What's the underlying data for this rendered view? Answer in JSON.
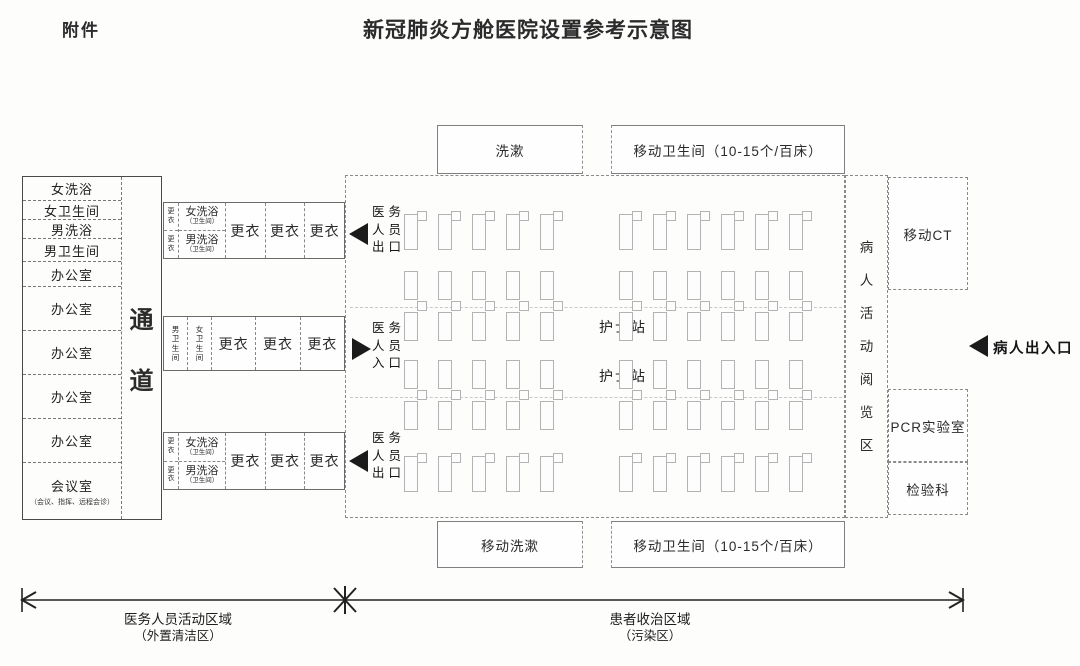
{
  "header": {
    "attachment": "附件",
    "title": "新冠肺炎方舱医院设置参考示意图"
  },
  "left_block": {
    "rooms": [
      "女洗浴",
      "女卫生间",
      "男洗浴",
      "男卫生间",
      "办公室",
      "办公室",
      "办公室",
      "办公室",
      "办公室"
    ],
    "meeting_room": {
      "label": "会议室",
      "note": "（会议、指挥、远程会诊）"
    },
    "corridor_chars": [
      "通",
      "道"
    ]
  },
  "top_band": {
    "changing_small": [
      "更衣",
      "更衣"
    ],
    "female_shower": "女洗浴",
    "female_shower_note": "（卫生间）",
    "male_shower": "男洗浴",
    "male_shower_note": "（卫生间）",
    "changing_rooms": [
      "更衣",
      "更衣",
      "更衣"
    ]
  },
  "middle_band": {
    "male_wc": "男卫生间",
    "female_wc": "女卫生间",
    "changing_rooms": [
      "更衣",
      "更衣",
      "更衣"
    ]
  },
  "bottom_band": {
    "changing_small": [
      "更衣",
      "更衣"
    ],
    "female_shower": "女洗浴",
    "female_shower_note": "（卫生间）",
    "male_shower": "男洗浴",
    "male_shower_note": "（卫生间）",
    "changing_rooms": [
      "更衣",
      "更衣",
      "更衣"
    ]
  },
  "staff_doors": [
    {
      "lines": [
        "医务",
        "人员",
        "出口"
      ],
      "direction": "left"
    },
    {
      "lines": [
        "医务",
        "人员",
        "入口"
      ],
      "direction": "right"
    },
    {
      "lines": [
        "医务",
        "人员",
        "出口"
      ],
      "direction": "left"
    }
  ],
  "utility_top": {
    "wash": "洗漱",
    "mobile_toilet": "移动卫生间（10-15个/百床）"
  },
  "utility_bottom": {
    "wash": "移动洗漱",
    "mobile_toilet": "移动卫生间（10-15个/百床）"
  },
  "ward": {
    "nurse_stations": [
      "护士站",
      "护士站"
    ],
    "reading_area": "病人活动阅览区",
    "beds": {
      "bands": [
        {
          "type": "single",
          "left": 5,
          "right": 6
        },
        {
          "type": "double",
          "left": 5,
          "right": 6
        },
        {
          "type": "double",
          "left": 5,
          "right": 6
        },
        {
          "type": "single",
          "left": 5,
          "right": 6
        }
      ]
    }
  },
  "right_rooms": [
    "移动CT",
    "PCR实验室",
    "检验科"
  ],
  "patient_door": {
    "label": "病人出入口"
  },
  "zones": [
    {
      "label": "医务人员活动区域",
      "note": "（外置清洁区）"
    },
    {
      "label": "患者收治区域",
      "note": "（污染区）"
    }
  ],
  "colors": {
    "ink": "#2b2b2b",
    "bed_outline": "#b3b3b3",
    "arrow": "#1b1b1b"
  }
}
